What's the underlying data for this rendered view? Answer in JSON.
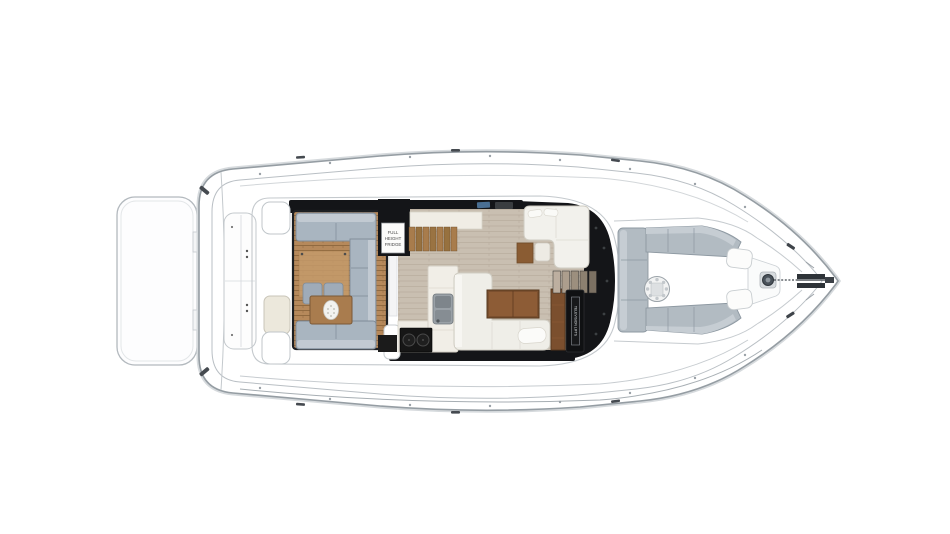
{
  "diagram": {
    "labels": {
      "fridge_line1": "FULL",
      "fridge_line2": "HEIGHT",
      "fridge_line3": "FRIDGE",
      "tv_lift": "TELEVISION LIFTS"
    },
    "colors": {
      "hull_line": "#9aa3a9",
      "cockpit_teak": "#b6895b",
      "salon_floor": "#c9bfb1",
      "sofa_blue_gray": "#a9b5c0",
      "bow_lounge_gray": "#b2bbc2",
      "walnut_wood": "#7b4f2e",
      "panel_black": "#141518",
      "counter_white": "#f0ede5"
    }
  }
}
